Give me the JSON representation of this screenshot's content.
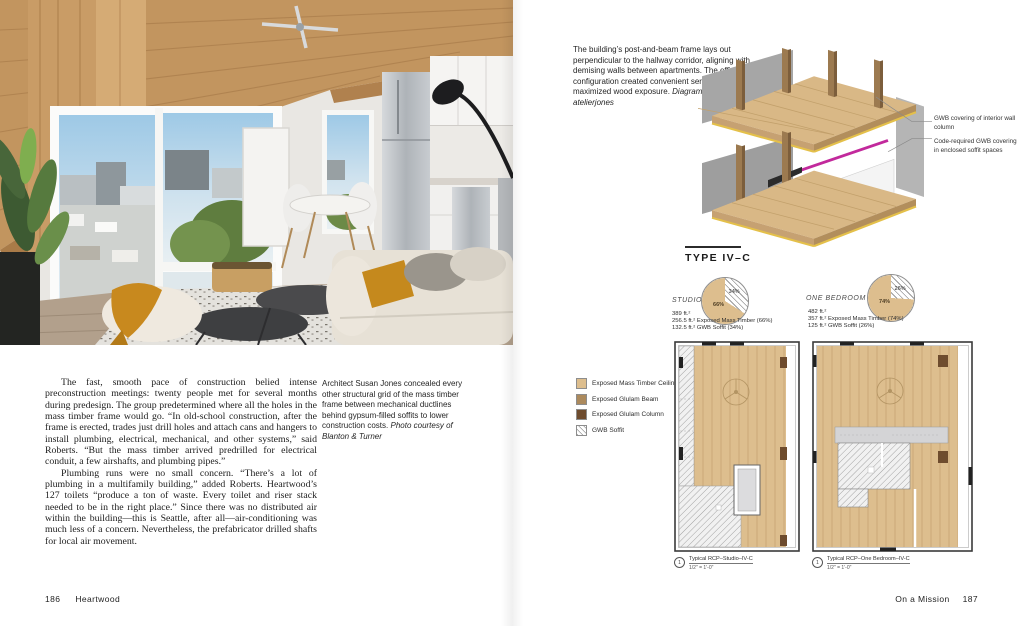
{
  "book": {
    "left_folio": "186",
    "left_running_head": "Heartwood",
    "right_running_head": "On a Mission",
    "right_folio": "187"
  },
  "left_page": {
    "paragraphs": [
      "The fast, smooth pace of construction belied intense preconstruction meetings: twenty people met for several months during predesign. The group predetermined where all the holes in the mass timber frame would go. “In old-school construction, after the frame is erected, trades just drill holes and attach cans and hangers to install plumbing, electrical, mechanical, and other systems,” said Roberts. “But the mass timber arrived predrilled for electrical conduit, a few airshafts, and plumbing pipes.”",
      "Plumbing runs were no small concern. “There’s a lot of plumbing in a multifamily building,” added Roberts. Heartwood’s 127 toilets “produce a ton of waste. Every toilet and riser stack needed to be in the right place.” Since there was no distributed air within the building—this is Seattle, after all—air-conditioning was much less of a concern. Nevertheless, the prefabricator drilled shafts for local air movement."
    ],
    "photo_caption": "Architect Susan Jones concealed every other structural grid of the mass timber frame between mechanical ductlines behind gypsum-filled soffits to lower construction costs. ",
    "photo_credit": "Photo courtesy of Blanton & Turner"
  },
  "right_page": {
    "diagram_caption": "The building’s post-and-beam frame lays out perpendicular to the hallway corridor, aligning with demising walls between apartments. The efficient configuration created convenient service paths and maximized wood exposure. ",
    "diagram_credit": "Diagrams courtesy of atelierjones",
    "axon_labels": [
      "GWB covering of interior wall column",
      "Code-required GWB covering in enclosed soffit spaces"
    ],
    "section_title": "TYPE IV–C",
    "units": [
      {
        "name": "STUDIO",
        "area": "389 ft.²",
        "stat_timber": "256.5 ft.² Exposed Mass Timber (66%)",
        "stat_gwb": "132.5 ft.² GWB Soffit (34%)",
        "pie": {
          "timber_pct": 66,
          "gwb_pct": 34,
          "timber_label": "66%",
          "gwb_label": "34%"
        }
      },
      {
        "name": "ONE BEDROOM",
        "area": "482 ft.²",
        "stat_timber": "357 ft.² Exposed Mass Timber (74%)",
        "stat_gwb": "125 ft.² GWB Soffit (26%)",
        "pie": {
          "timber_pct": 74,
          "gwb_pct": 26,
          "timber_label": "74%",
          "gwb_label": "26%"
        }
      }
    ],
    "legend": [
      {
        "label": "Exposed Mass Timber Ceiling",
        "swatch": "mass_timber"
      },
      {
        "label": "Exposed Glulam Beam",
        "swatch": "glulam_beam"
      },
      {
        "label": "Exposed Glulam Column",
        "swatch": "glulam_column"
      },
      {
        "label": "GWB Soffit",
        "swatch": "hatch"
      }
    ],
    "plan_captions": [
      {
        "num": "1",
        "title": "Typical RCP–Studio–IV-C",
        "scale": "1/2\" = 1'-0\""
      },
      {
        "num": "1",
        "title": "Typical RCP–One Bedroom–IV-C",
        "scale": "1/2\" = 1'-0\""
      }
    ]
  },
  "colors": {
    "mass_timber": "#ddbe8e",
    "glulam_beam": "#ac8a5d",
    "glulam_column": "#6e4c2e",
    "plan_gray": "#d4d4d6",
    "accent_yellow": "#e4c04a",
    "duct_magenta": "#c2299c"
  },
  "chart_data": [
    {
      "type": "pie",
      "title": "STUDIO",
      "labels": [
        "Exposed Mass Timber",
        "GWB Soffit"
      ],
      "values": [
        66,
        34
      ],
      "units": "percent"
    },
    {
      "type": "pie",
      "title": "ONE BEDROOM",
      "labels": [
        "Exposed Mass Timber",
        "GWB Soffit"
      ],
      "values": [
        74,
        26
      ],
      "units": "percent"
    }
  ]
}
